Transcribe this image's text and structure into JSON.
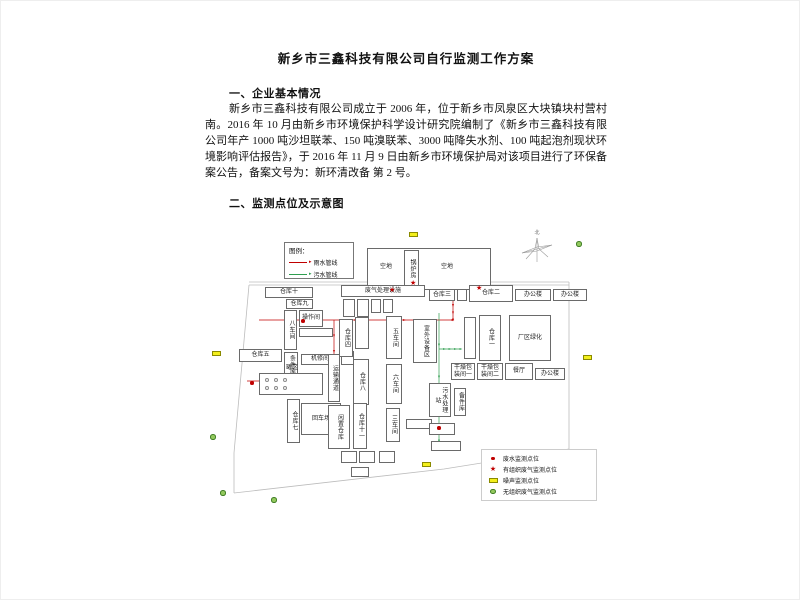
{
  "document": {
    "title": "新乡市三鑫科技有限公司自行监测工作方案",
    "sections": [
      {
        "heading": "一、企业基本情况",
        "paragraph": "新乡市三鑫科技有限公司成立于 2006 年，位于新乡市凤泉区大块镇块村营村南。2016 年 10 月由新乡市环境保护科学设计研究院编制了《新乡市三鑫科技有限公司年产 1000 吨沙坦联苯、150 吨溴联苯、3000 吨降失水剂、100 吨起泡剂现状环境影响评估报告》，于 2016 年 11 月 9 日由新乡市环境保护局对该项目进行了环保备案公告，备案文号为：新环清改备 第 2 号。"
      },
      {
        "heading": "二、监测点位及示意图",
        "paragraph": ""
      }
    ]
  },
  "map": {
    "compass_label": "北",
    "pipe_legend": {
      "title": "图例：",
      "items": [
        {
          "label": "雨水管线",
          "color": "#c00000"
        },
        {
          "label": "污水管线",
          "color": "#2f9e4f"
        }
      ]
    },
    "marker_legend": [
      {
        "type": "dot",
        "label": "废水监测点位"
      },
      {
        "type": "star",
        "label": "有组织废气监测点位"
      },
      {
        "type": "noise",
        "label": "噪声监测点位"
      },
      {
        "type": "gas",
        "label": "无组织废气监测点位"
      }
    ],
    "colors": {
      "rain": "#c00000",
      "sewage": "#2f9e4f",
      "noise_fill": "#f3ef1c",
      "noise_border": "#8a8a00",
      "gas_fill": "#93c95e",
      "gas_border": "#3f7d23",
      "star": "#c00000",
      "dot": "#c00000",
      "boundary": "#bcbcbc",
      "tank": "#9a9a9a"
    },
    "buildings": [
      {
        "label": "",
        "x": 166,
        "y": 27,
        "w": 124,
        "h": 42
      },
      {
        "label": "空地",
        "x": 168,
        "y": 38,
        "w": 34,
        "h": 16,
        "plain": 1
      },
      {
        "label": "锅炉房",
        "x": 203,
        "y": 29,
        "w": 15,
        "h": 38,
        "v": 1
      },
      {
        "label": "空地",
        "x": 224,
        "y": 38,
        "w": 44,
        "h": 16,
        "plain": 1
      },
      {
        "label": "仓库十",
        "x": 64,
        "y": 66,
        "w": 48,
        "h": 11
      },
      {
        "label": "仓库九",
        "x": 85,
        "y": 78,
        "w": 27,
        "h": 10
      },
      {
        "label": "八车间",
        "x": 83,
        "y": 89,
        "w": 13,
        "h": 40,
        "v": 1
      },
      {
        "label": "操作间",
        "x": 98,
        "y": 89,
        "w": 24,
        "h": 17
      },
      {
        "label": "",
        "x": 98,
        "y": 107,
        "w": 34,
        "h": 9
      },
      {
        "label": "条件库",
        "x": 83,
        "y": 131,
        "w": 14,
        "h": 26,
        "v": 1
      },
      {
        "label": "仓库五",
        "x": 38,
        "y": 128,
        "w": 43,
        "h": 13
      },
      {
        "label": "机修间",
        "x": 100,
        "y": 133,
        "w": 38,
        "h": 11
      },
      {
        "label": "",
        "x": 140,
        "y": 130,
        "w": 13,
        "h": 14
      },
      {
        "label": "罐区",
        "x": 80,
        "y": 143,
        "w": 22,
        "h": 8,
        "plain": 1
      },
      {
        "label": "",
        "x": 58,
        "y": 152,
        "w": 64,
        "h": 22
      },
      {
        "label": "运输通道",
        "x": 127,
        "y": 133,
        "w": 12,
        "h": 48,
        "v": 1
      },
      {
        "label": "仓库八",
        "x": 152,
        "y": 138,
        "w": 16,
        "h": 46,
        "v": 1
      },
      {
        "label": "废气处理设施",
        "x": 140,
        "y": 64,
        "w": 84,
        "h": 12
      },
      {
        "label": "",
        "x": 142,
        "y": 78,
        "w": 12,
        "h": 18
      },
      {
        "label": "",
        "x": 156,
        "y": 78,
        "w": 12,
        "h": 18
      },
      {
        "label": "",
        "x": 170,
        "y": 78,
        "w": 10,
        "h": 14
      },
      {
        "label": "",
        "x": 182,
        "y": 78,
        "w": 10,
        "h": 14
      },
      {
        "label": "仓库四",
        "x": 138,
        "y": 98,
        "w": 14,
        "h": 38,
        "v": 1
      },
      {
        "label": "",
        "x": 154,
        "y": 96,
        "w": 14,
        "h": 32,
        "v": 1
      },
      {
        "label": "五车间",
        "x": 185,
        "y": 95,
        "w": 16,
        "h": 43,
        "v": 1
      },
      {
        "label": "室外设备区",
        "x": 212,
        "y": 98,
        "w": 24,
        "h": 44,
        "v": 1
      },
      {
        "label": "六车间",
        "x": 185,
        "y": 143,
        "w": 16,
        "h": 40,
        "v": 1
      },
      {
        "label": "污水处理站",
        "x": 228,
        "y": 162,
        "w": 22,
        "h": 34,
        "v": 1
      },
      {
        "label": "备件库",
        "x": 253,
        "y": 167,
        "w": 12,
        "h": 28,
        "v": 1
      },
      {
        "label": "仓库三",
        "x": 228,
        "y": 68,
        "w": 26,
        "h": 12
      },
      {
        "label": "",
        "x": 256,
        "y": 68,
        "w": 10,
        "h": 12
      },
      {
        "label": "仓库二",
        "x": 268,
        "y": 64,
        "w": 44,
        "h": 17
      },
      {
        "label": "办公楼",
        "x": 314,
        "y": 68,
        "w": 36,
        "h": 12
      },
      {
        "label": "办公楼",
        "x": 352,
        "y": 68,
        "w": 34,
        "h": 12
      },
      {
        "label": "",
        "x": 263,
        "y": 96,
        "w": 12,
        "h": 42,
        "v": 1
      },
      {
        "label": "仓库一",
        "x": 278,
        "y": 94,
        "w": 22,
        "h": 46,
        "v": 1
      },
      {
        "label": "厂区绿化",
        "x": 308,
        "y": 94,
        "w": 42,
        "h": 46
      },
      {
        "label": "干燥包装间一",
        "x": 250,
        "y": 142,
        "w": 24,
        "h": 17
      },
      {
        "label": "干燥包装间二",
        "x": 276,
        "y": 142,
        "w": 26,
        "h": 17
      },
      {
        "label": "餐厅",
        "x": 304,
        "y": 142,
        "w": 28,
        "h": 17
      },
      {
        "label": "办公楼",
        "x": 334,
        "y": 147,
        "w": 30,
        "h": 12
      },
      {
        "label": "仓库七",
        "x": 86,
        "y": 178,
        "w": 13,
        "h": 44,
        "v": 1
      },
      {
        "label": "回车场",
        "x": 100,
        "y": 182,
        "w": 40,
        "h": 32
      },
      {
        "label": "闲置仓库",
        "x": 127,
        "y": 184,
        "w": 22,
        "h": 44,
        "v": 1
      },
      {
        "label": "仓库十一",
        "x": 152,
        "y": 182,
        "w": 14,
        "h": 46,
        "v": 1
      },
      {
        "label": "三车间",
        "x": 185,
        "y": 187,
        "w": 14,
        "h": 34,
        "v": 1
      },
      {
        "label": "",
        "x": 205,
        "y": 198,
        "w": 26,
        "h": 10
      },
      {
        "label": "",
        "x": 228,
        "y": 202,
        "w": 26,
        "h": 12
      },
      {
        "label": "",
        "x": 230,
        "y": 220,
        "w": 30,
        "h": 10
      },
      {
        "label": "",
        "x": 140,
        "y": 230,
        "w": 16,
        "h": 12
      },
      {
        "label": "",
        "x": 158,
        "y": 230,
        "w": 16,
        "h": 12
      },
      {
        "label": "",
        "x": 178,
        "y": 230,
        "w": 16,
        "h": 12
      },
      {
        "label": "",
        "x": 150,
        "y": 246,
        "w": 18,
        "h": 10
      }
    ],
    "markers": [
      {
        "t": "star",
        "x": 188,
        "y": 66
      },
      {
        "t": "star",
        "x": 209,
        "y": 59
      },
      {
        "t": "star",
        "x": 275,
        "y": 64
      },
      {
        "t": "dot",
        "x": 49,
        "y": 160
      },
      {
        "t": "dot",
        "x": 236,
        "y": 205
      },
      {
        "t": "dot",
        "x": 100,
        "y": 98
      },
      {
        "t": "noise",
        "x": 208,
        "y": 11
      },
      {
        "t": "noise",
        "x": 11,
        "y": 130
      },
      {
        "t": "noise",
        "x": 382,
        "y": 134
      },
      {
        "t": "noise",
        "x": 221,
        "y": 241
      },
      {
        "t": "gas",
        "x": 375,
        "y": 20
      },
      {
        "t": "gas",
        "x": 9,
        "y": 213
      },
      {
        "t": "gas",
        "x": 19,
        "y": 269
      },
      {
        "t": "gas",
        "x": 70,
        "y": 276
      },
      {
        "t": "tank",
        "x": 64,
        "y": 157
      },
      {
        "t": "tank",
        "x": 73,
        "y": 157
      },
      {
        "t": "tank",
        "x": 82,
        "y": 157
      },
      {
        "t": "tank",
        "x": 64,
        "y": 165
      },
      {
        "t": "tank",
        "x": 73,
        "y": 165
      },
      {
        "t": "tank",
        "x": 82,
        "y": 165
      }
    ],
    "pipes": [
      {
        "kind": "rain",
        "points": [
          [
            58,
            99
          ],
          [
            252,
            99
          ]
        ]
      },
      {
        "kind": "rain",
        "points": [
          [
            133,
            99
          ],
          [
            133,
            162
          ]
        ]
      },
      {
        "kind": "rain",
        "points": [
          [
            46,
            160
          ],
          [
            104,
            160
          ]
        ]
      },
      {
        "kind": "rain",
        "points": [
          [
            252,
            70
          ],
          [
            252,
            99
          ]
        ]
      },
      {
        "kind": "sewage",
        "points": [
          [
            238,
            92
          ],
          [
            238,
            220
          ]
        ]
      },
      {
        "kind": "sewage",
        "points": [
          [
            238,
            128
          ],
          [
            260,
            128
          ]
        ]
      }
    ],
    "boundary": [
      [
        [
          48,
          61
        ],
        [
          368,
          61
        ]
      ],
      [
        [
          48,
          64
        ],
        [
          368,
          64
        ]
      ],
      [
        [
          48,
          64
        ],
        [
          33,
          232
        ],
        [
          33,
          272
        ]
      ],
      [
        [
          33,
          272
        ],
        [
          243,
          248
        ],
        [
          368,
          228
        ]
      ],
      [
        [
          368,
          228
        ],
        [
          368,
          61
        ]
      ]
    ]
  }
}
